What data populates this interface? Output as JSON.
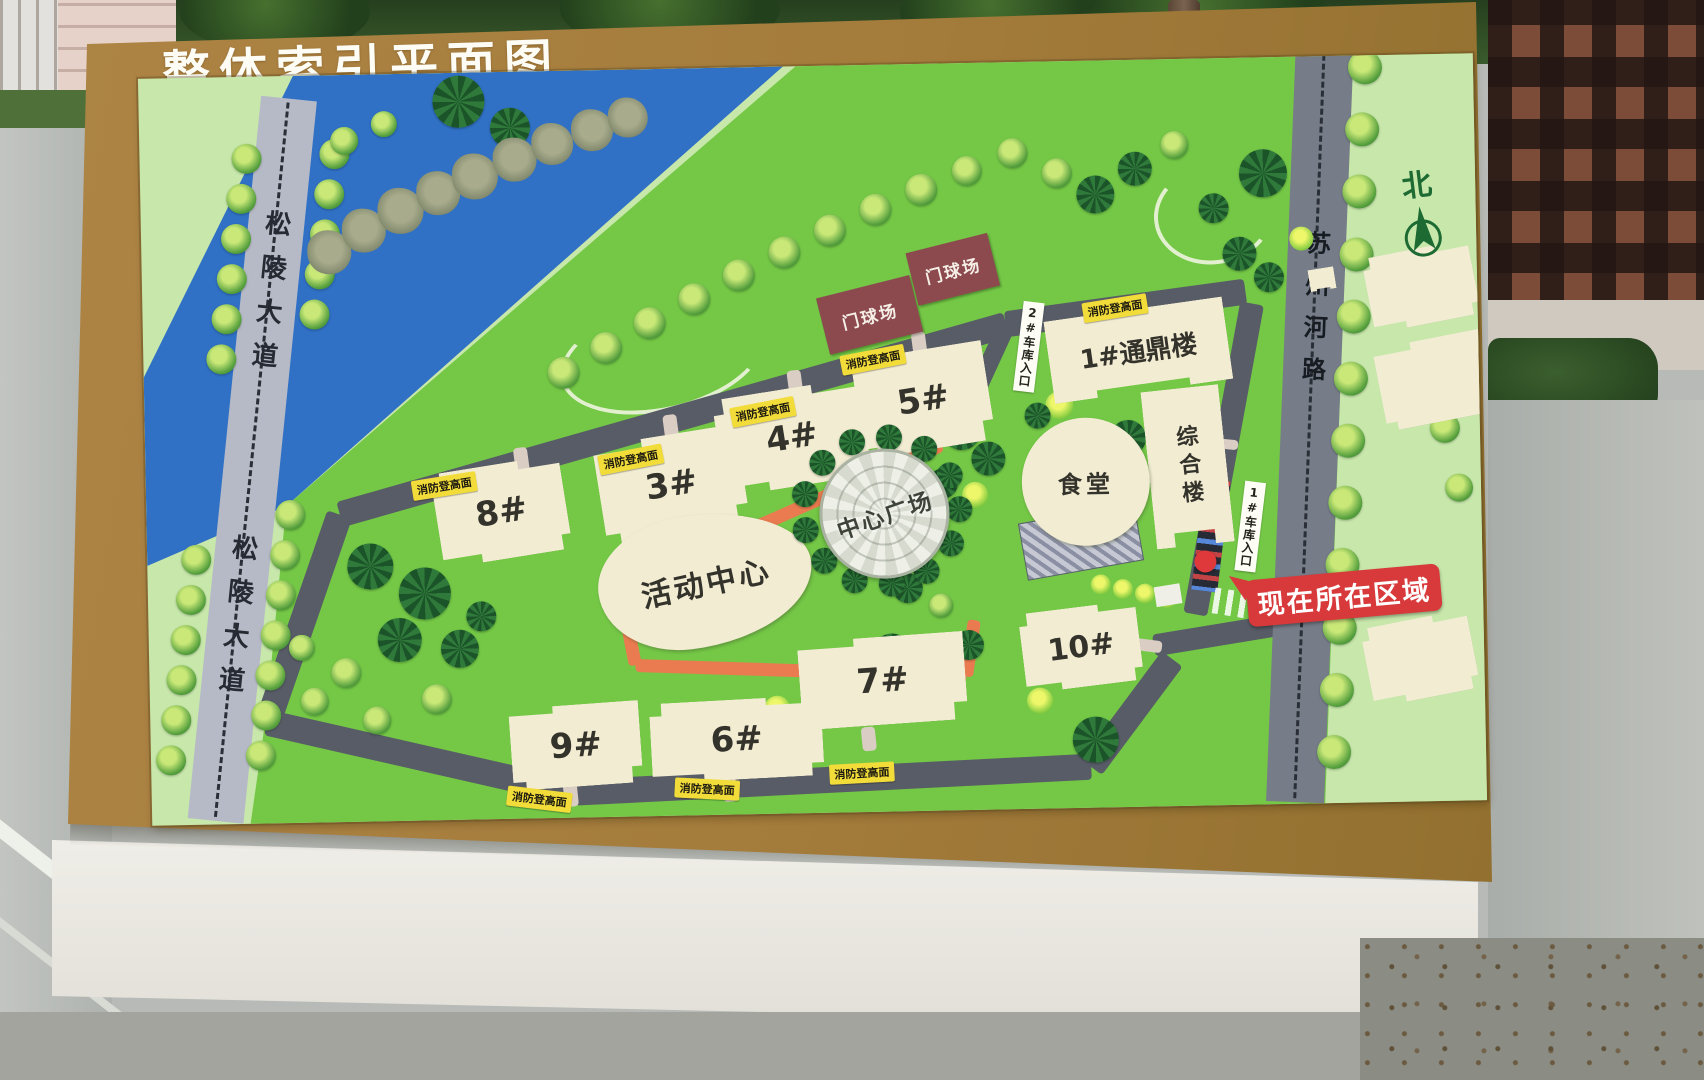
{
  "board": {
    "title": "整体索引平面图"
  },
  "map": {
    "origin": [
      145,
      66
    ],
    "north": {
      "label": "北",
      "x": 1402,
      "y": 172
    },
    "left_road": {
      "label": "松陵大道",
      "cx_top": 296,
      "y_top": 86,
      "cx_bot": 208,
      "y_bot": 812,
      "w": 56,
      "label_tops": [
        112,
        438
      ],
      "font": 26
    },
    "right_road": {
      "label": "苏州河路",
      "cx_top": 1332,
      "y_top": 60,
      "cx_bot": 1288,
      "y_bot": 812,
      "w": 58,
      "label_tops": [
        180
      ],
      "font": 24
    },
    "river_polygon": [
      [
        155,
        0
      ],
      [
        645,
        0
      ],
      [
        140,
        430
      ],
      [
        -12,
        492
      ],
      [
        -12,
        322
      ]
    ],
    "bright_polygon": [
      [
        140,
        430
      ],
      [
        665,
        -6
      ],
      [
        1327,
        -10
      ],
      [
        1317,
        749
      ],
      [
        98,
        749
      ],
      [
        117,
        632
      ]
    ],
    "right_strip_polygon": [
      [
        1215,
        -8
      ],
      [
        1337,
        -13
      ],
      [
        1337,
        749
      ],
      [
        1173,
        749
      ]
    ],
    "colors": {
      "ring": "#575c66",
      "track": "#ea7b50",
      "stub": "#d9cdc4",
      "bright": "#74c846",
      "outer": "#c7e7ab",
      "river": "#3070c5",
      "left_road": "#b6bac6",
      "right_road": "#767c88"
    },
    "ring_segments": [
      [
        338,
        505,
        1008,
        328,
        26
      ],
      [
        1008,
        328,
        1248,
        300,
        26
      ],
      [
        338,
        505,
        262,
        712,
        26
      ],
      [
        262,
        712,
        568,
        788,
        26
      ],
      [
        568,
        788,
        1085,
        772,
        26
      ],
      [
        1085,
        772,
        1168,
        665,
        26
      ],
      [
        1255,
        312,
        1192,
        622,
        24
      ],
      [
        1150,
        652,
        1302,
        630,
        22
      ],
      [
        1008,
        330,
        952,
        446,
        18
      ]
    ],
    "track_segments": [
      [
        617,
        583,
        942,
        447,
        13
      ],
      [
        617,
        583,
        631,
        662,
        13
      ],
      [
        631,
        662,
        962,
        679,
        13
      ],
      [
        962,
        679,
        971,
        623,
        13
      ]
    ],
    "stub_segments": [
      [
        520,
        442,
        523,
        468,
        14
      ],
      [
        670,
        412,
        673,
        438,
        14
      ],
      [
        795,
        370,
        798,
        396,
        14
      ],
      [
        920,
        334,
        923,
        360,
        14
      ],
      [
        563,
        778,
        565,
        802,
        14
      ],
      [
        722,
        776,
        724,
        800,
        14
      ],
      [
        862,
        728,
        864,
        752,
        14
      ],
      [
        1130,
        650,
        1158,
        654,
        12
      ],
      [
        1212,
        450,
        1238,
        453,
        10
      ]
    ],
    "buildings": [
      {
        "label": "8#",
        "x": 435,
        "y": 458,
        "w": 130,
        "h": 95,
        "rot": -8,
        "clip": 1,
        "fs": 34
      },
      {
        "label": "3#",
        "x": 598,
        "y": 432,
        "w": 145,
        "h": 100,
        "rot": -8,
        "clip": 2,
        "fs": 34
      },
      {
        "label": "4#",
        "x": 718,
        "y": 388,
        "w": 148,
        "h": 98,
        "rot": -8,
        "clip": 1,
        "fs": 34
      },
      {
        "label": "5#",
        "x": 858,
        "y": 352,
        "w": 132,
        "h": 100,
        "rot": -8,
        "clip": 2,
        "fs": 34
      },
      {
        "label": "9#",
        "x": 505,
        "y": 700,
        "w": 130,
        "h": 82,
        "rot": -3,
        "clip": 2,
        "fs": 34
      },
      {
        "label": "6#",
        "x": 645,
        "y": 698,
        "w": 172,
        "h": 80,
        "rot": -2,
        "clip": 1,
        "fs": 34
      },
      {
        "label": "7#",
        "x": 795,
        "y": 638,
        "w": 166,
        "h": 88,
        "rot": -3,
        "clip": 2,
        "fs": 34
      },
      {
        "label": "10#",
        "x": 1018,
        "y": 612,
        "w": 118,
        "h": 80,
        "rot": -6,
        "clip": 1,
        "fs": 30
      },
      {
        "label": "1#通鼎楼",
        "x": 1050,
        "y": 315,
        "w": 180,
        "h": 83,
        "rot": -7,
        "clip": 3,
        "fs": 26
      },
      {
        "label": "综合楼",
        "x": 1148,
        "y": 395,
        "w": 78,
        "h": 158,
        "rot": -5,
        "clip": 3,
        "fs": 22,
        "vertical": true
      },
      {
        "label": "",
        "x": 1370,
        "y": 260,
        "w": 108,
        "h": 76,
        "rot": -10,
        "clip": 1,
        "fs": 20
      },
      {
        "label": "",
        "x": 1380,
        "y": 350,
        "w": 112,
        "h": 84,
        "rot": -10,
        "clip": 2,
        "fs": 20
      },
      {
        "label": "",
        "x": 1362,
        "y": 630,
        "w": 108,
        "h": 80,
        "rot": -10,
        "clip": 1,
        "fs": 20
      },
      {
        "label": "",
        "x": 1312,
        "y": 278,
        "w": 26,
        "h": 22,
        "rot": -8,
        "clip": 3,
        "fs": 10
      }
    ],
    "canteen": {
      "label": "食堂",
      "cx": 1085,
      "cy": 487,
      "d": 128,
      "fs": 24
    },
    "activity": {
      "label": "活动中心",
      "x": 595,
      "y": 512,
      "w": 215,
      "h": 133,
      "rot": -6,
      "fs": 30
    },
    "plaza": {
      "label": "中心广场",
      "cx": 880,
      "cy": 512,
      "d": 124,
      "ring": 13,
      "fs": 23
    },
    "courts": [
      {
        "label": "门球场",
        "cx": 872,
        "cy": 316,
        "w": 96,
        "h": 58,
        "rot": -13
      },
      {
        "label": "门球场",
        "cx": 956,
        "cy": 272,
        "w": 84,
        "h": 54,
        "rot": -13
      }
    ],
    "fire_label": "消防登高面",
    "fire_positions": [
      [
        443,
        478,
        -8
      ],
      [
        630,
        455,
        -10
      ],
      [
        763,
        410,
        -10
      ],
      [
        874,
        360,
        -10
      ],
      [
        1117,
        313,
        -8
      ],
      [
        532,
        793,
        8
      ],
      [
        700,
        786,
        4
      ],
      [
        855,
        773,
        -2
      ]
    ],
    "garage_labels": [
      {
        "label": "2#车库入口",
        "cx": 1031,
        "cy": 348,
        "rot": 8
      },
      {
        "label": "1#车库入口",
        "cx": 1249,
        "cy": 532,
        "rot": 8
      }
    ],
    "you_are_here": {
      "label": "现在所在区域",
      "dot": [
        1203,
        569
      ],
      "box": [
        1244,
        582
      ],
      "rot": -4
    },
    "parking": {
      "x": 1020,
      "y": 518,
      "w": 116,
      "h": 56,
      "rot": -9
    },
    "gate": {
      "x": 1196,
      "y": 487,
      "w": 26,
      "h": 112,
      "rot": 8
    },
    "booth": {
      "x": 1152,
      "y": 592,
      "w": 26,
      "h": 20,
      "rot": -8
    },
    "zebra": {
      "x": 1210,
      "y": 600,
      "w": 58,
      "h": 26,
      "rot": 10
    },
    "arcs": [
      {
        "x": 1158,
        "y": 172,
        "w": 112,
        "h": 92,
        "rot": -8
      },
      {
        "x": 560,
        "y": 300,
        "w": 200,
        "h": 100,
        "rot": -12
      }
    ],
    "tree_rows": [
      {
        "t": "r",
        "x0": 252,
        "y0": 148,
        "x1": 165,
        "y1": 748,
        "n": 16,
        "d": 30,
        "skip": [
          [
            385,
            520
          ]
        ]
      },
      {
        "t": "r",
        "x0": 340,
        "y0": 145,
        "x1": 255,
        "y1": 745,
        "n": 16,
        "d": 30,
        "skip": [
          [
            325,
            485
          ]
        ]
      },
      {
        "t": "r",
        "x0": 1372,
        "y0": 78,
        "x1": 1328,
        "y1": 762,
        "n": 12,
        "d": 34,
        "skip": []
      }
    ],
    "trees": [
      [
        350,
        132,
        28,
        "r"
      ],
      [
        390,
        116,
        26,
        "r"
      ],
      [
        465,
        95,
        52,
        "d"
      ],
      [
        516,
        122,
        40,
        "d"
      ],
      [
        333,
        243,
        44,
        "p"
      ],
      [
        368,
        222,
        44,
        "p"
      ],
      [
        405,
        203,
        46,
        "p"
      ],
      [
        443,
        186,
        44,
        "p"
      ],
      [
        480,
        170,
        46,
        "p"
      ],
      [
        520,
        154,
        44,
        "p"
      ],
      [
        558,
        139,
        42,
        "p"
      ],
      [
        598,
        126,
        42,
        "p"
      ],
      [
        634,
        114,
        40,
        "p"
      ],
      [
        565,
        368,
        32,
        "r"
      ],
      [
        608,
        344,
        32,
        "r"
      ],
      [
        652,
        320,
        32,
        "r"
      ],
      [
        697,
        297,
        32,
        "r"
      ],
      [
        742,
        274,
        32,
        "r"
      ],
      [
        788,
        252,
        32,
        "r"
      ],
      [
        834,
        231,
        32,
        "r"
      ],
      [
        880,
        211,
        32,
        "r"
      ],
      [
        926,
        192,
        32,
        "r"
      ],
      [
        972,
        174,
        30,
        "r"
      ],
      [
        1018,
        157,
        30,
        "r"
      ],
      [
        1062,
        178,
        30,
        "r"
      ],
      [
        1100,
        200,
        38,
        "d"
      ],
      [
        1140,
        175,
        34,
        "d"
      ],
      [
        1180,
        152,
        28,
        "r"
      ],
      [
        1218,
        216,
        30,
        "d"
      ],
      [
        1243,
        262,
        34,
        "d"
      ],
      [
        1272,
        286,
        30,
        "d"
      ],
      [
        1268,
        182,
        48,
        "d"
      ],
      [
        1305,
        248,
        24,
        "b"
      ],
      [
        962,
        434,
        38,
        "d"
      ],
      [
        988,
        462,
        34,
        "d"
      ],
      [
        942,
        486,
        30,
        "d"
      ],
      [
        974,
        498,
        26,
        "b"
      ],
      [
        1060,
        410,
        28,
        "b"
      ],
      [
        1128,
        444,
        36,
        "d"
      ],
      [
        1038,
        420,
        26,
        "d"
      ],
      [
        760,
        560,
        30,
        "d"
      ],
      [
        368,
        558,
        46,
        "d"
      ],
      [
        422,
        586,
        52,
        "d"
      ],
      [
        396,
        632,
        44,
        "d"
      ],
      [
        456,
        642,
        38,
        "d"
      ],
      [
        342,
        664,
        30,
        "r"
      ],
      [
        310,
        692,
        28,
        "r"
      ],
      [
        432,
        692,
        30,
        "r"
      ],
      [
        372,
        712,
        28,
        "r"
      ],
      [
        298,
        638,
        26,
        "r"
      ],
      [
        478,
        610,
        30,
        "d"
      ],
      [
        905,
        590,
        30,
        "d"
      ],
      [
        938,
        608,
        24,
        "r"
      ],
      [
        888,
        655,
        40,
        "d"
      ],
      [
        930,
        690,
        36,
        "d"
      ],
      [
        772,
        708,
        26,
        "b"
      ],
      [
        965,
        648,
        30,
        "d"
      ],
      [
        1035,
        705,
        26,
        "b"
      ],
      [
        1090,
        745,
        46,
        "d"
      ],
      [
        1098,
        590,
        20,
        "b"
      ],
      [
        1120,
        595,
        20,
        "b"
      ],
      [
        1142,
        600,
        20,
        "b"
      ],
      [
        1164,
        605,
        20,
        "b"
      ],
      [
        1445,
        440,
        30,
        "r"
      ],
      [
        1458,
        500,
        28,
        "r"
      ]
    ]
  }
}
